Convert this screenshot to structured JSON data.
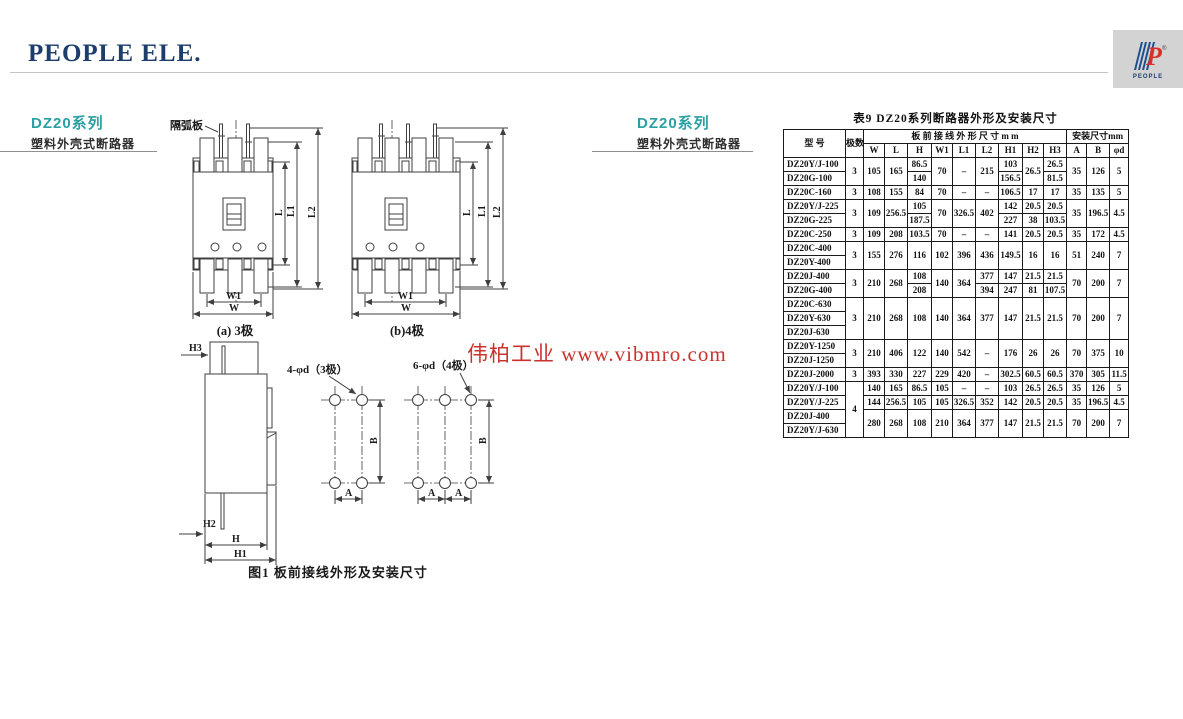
{
  "page": {
    "brand": "PEOPLE ELE.",
    "logo": {
      "p": "P",
      "word": "PEOPLE",
      "reg": "®"
    }
  },
  "sections": {
    "left_heading": {
      "series": "DZ20系列",
      "subtitle": "塑料外壳式断路器"
    },
    "mid_heading": {
      "series": "DZ20系列",
      "subtitle": "塑料外壳式断路器"
    }
  },
  "figure": {
    "arc_plate_label": "隔弧板",
    "caption_a": "(a) 3极",
    "caption_b": "(b)4极",
    "hole_label_3p": "4-φd（3极）",
    "hole_label_4p": "6-φd（4极）",
    "caption": "图1 板前接线外形及安装尺寸",
    "dims": {
      "L": "L",
      "L1": "L1",
      "L2": "L2",
      "W": "W",
      "W1": "W1",
      "H": "H",
      "H1": "H1",
      "H2": "H2",
      "H3": "H3",
      "A": "A",
      "B": "B"
    }
  },
  "watermark": "伟柏工业 www.vibmro.com",
  "table": {
    "title": "表9 DZ20系列断路器外形及安装尺寸",
    "header": {
      "model": "型  号",
      "poles": "极数",
      "group1": "板 前 接 线 外 形 尺 寸 m m",
      "group2": "安装尺寸mm",
      "cols": [
        "W",
        "L",
        "H",
        "W1",
        "L1",
        "L2",
        "H1",
        "H2",
        "H3",
        "A",
        "B",
        "φd"
      ]
    },
    "rows": [
      [
        [
          "DZ20Y/J-100"
        ],
        [
          "3",
          2
        ],
        [
          "105",
          2
        ],
        [
          "165",
          2
        ],
        [
          "86.5"
        ],
        [
          "70",
          2
        ],
        [
          "–",
          2
        ],
        [
          "215",
          2
        ],
        [
          "103"
        ],
        [
          "26.5",
          2
        ],
        [
          "26.5"
        ],
        [
          "35",
          2
        ],
        [
          "126",
          2
        ],
        [
          "5",
          2
        ]
      ],
      [
        [
          "DZ20G-100"
        ],
        [
          "140"
        ],
        [
          "156.5"
        ],
        [
          "81.5"
        ]
      ],
      [
        [
          "DZ20C-160"
        ],
        [
          "3"
        ],
        [
          "108"
        ],
        [
          "155"
        ],
        [
          "84"
        ],
        [
          "70"
        ],
        [
          "–"
        ],
        [
          "–"
        ],
        [
          "106.5"
        ],
        [
          "17"
        ],
        [
          "17"
        ],
        [
          "35"
        ],
        [
          "135"
        ],
        [
          "5"
        ]
      ],
      [
        [
          "DZ20Y/J-225"
        ],
        [
          "3",
          2
        ],
        [
          "109",
          2
        ],
        [
          "256.5",
          2
        ],
        [
          "105"
        ],
        [
          "70",
          2
        ],
        [
          "326.5",
          2
        ],
        [
          "402",
          2
        ],
        [
          "142"
        ],
        [
          "20.5"
        ],
        [
          "20.5"
        ],
        [
          "35",
          2
        ],
        [
          "196.5",
          2
        ],
        [
          "4.5",
          2
        ]
      ],
      [
        [
          "DZ20G-225"
        ],
        [
          "187.5"
        ],
        [
          "227"
        ],
        [
          "38"
        ],
        [
          "103.5"
        ]
      ],
      [
        [
          "DZ20C-250"
        ],
        [
          "3"
        ],
        [
          "109"
        ],
        [
          "208"
        ],
        [
          "103.5"
        ],
        [
          "70"
        ],
        [
          "–"
        ],
        [
          "–"
        ],
        [
          "141"
        ],
        [
          "20.5"
        ],
        [
          "20.5"
        ],
        [
          "35"
        ],
        [
          "172"
        ],
        [
          "4.5"
        ]
      ],
      [
        [
          "DZ20C-400"
        ],
        [
          "3",
          2
        ],
        [
          "155",
          2
        ],
        [
          "276",
          2
        ],
        [
          "116",
          2
        ],
        [
          "102",
          2
        ],
        [
          "396",
          2
        ],
        [
          "436",
          2
        ],
        [
          "149.5",
          2
        ],
        [
          "16",
          2
        ],
        [
          "16",
          2
        ],
        [
          "51",
          2
        ],
        [
          "240",
          2
        ],
        [
          "7",
          2
        ]
      ],
      [
        [
          "DZ20Y-400"
        ]
      ],
      [
        [
          "DZ20J-400"
        ],
        [
          "3",
          2
        ],
        [
          "210",
          2
        ],
        [
          "268",
          2
        ],
        [
          "108"
        ],
        [
          "140",
          2
        ],
        [
          "364",
          2
        ],
        [
          "377"
        ],
        [
          "147"
        ],
        [
          "21.5"
        ],
        [
          "21.5"
        ],
        [
          "70",
          2
        ],
        [
          "200",
          2
        ],
        [
          "7",
          2
        ]
      ],
      [
        [
          "DZ20G-400"
        ],
        [
          "208"
        ],
        [
          "394"
        ],
        [
          "247"
        ],
        [
          "81"
        ],
        [
          "107.5"
        ]
      ],
      [
        [
          "DZ20C-630"
        ],
        [
          "3",
          3
        ],
        [
          "210",
          3
        ],
        [
          "268",
          3
        ],
        [
          "108",
          3
        ],
        [
          "140",
          3
        ],
        [
          "364",
          3
        ],
        [
          "377",
          3
        ],
        [
          "147",
          3
        ],
        [
          "21.5",
          3
        ],
        [
          "21.5",
          3
        ],
        [
          "70",
          3
        ],
        [
          "200",
          3
        ],
        [
          "7",
          3
        ]
      ],
      [
        [
          "DZ20Y-630"
        ]
      ],
      [
        [
          "DZ20J-630"
        ]
      ],
      [
        [
          "DZ20Y-1250"
        ],
        [
          "3",
          2
        ],
        [
          "210",
          2
        ],
        [
          "406",
          2
        ],
        [
          "122",
          2
        ],
        [
          "140",
          2
        ],
        [
          "542",
          2
        ],
        [
          "–",
          2
        ],
        [
          "176",
          2
        ],
        [
          "26",
          2
        ],
        [
          "26",
          2
        ],
        [
          "70",
          2
        ],
        [
          "375",
          2
        ],
        [
          "10",
          2
        ]
      ],
      [
        [
          "DZ20J-1250"
        ]
      ],
      [
        [
          "DZ20J-2000"
        ],
        [
          "3"
        ],
        [
          "393"
        ],
        [
          "330"
        ],
        [
          "227"
        ],
        [
          "229"
        ],
        [
          "420"
        ],
        [
          "–"
        ],
        [
          "302.5"
        ],
        [
          "60.5"
        ],
        [
          "60.5"
        ],
        [
          "370"
        ],
        [
          "305"
        ],
        [
          "11.5"
        ]
      ],
      [
        [
          "DZ20Y/J-100"
        ],
        [
          "4",
          4
        ],
        [
          "140"
        ],
        [
          "165"
        ],
        [
          "86.5"
        ],
        [
          "105"
        ],
        [
          "–"
        ],
        [
          "–"
        ],
        [
          "103"
        ],
        [
          "26.5"
        ],
        [
          "26.5"
        ],
        [
          "35"
        ],
        [
          "126"
        ],
        [
          "5"
        ]
      ],
      [
        [
          "DZ20Y/J-225"
        ],
        [
          "144"
        ],
        [
          "256.5"
        ],
        [
          "105"
        ],
        [
          "105"
        ],
        [
          "326.5"
        ],
        [
          "352"
        ],
        [
          "142"
        ],
        [
          "20.5"
        ],
        [
          "20.5"
        ],
        [
          "35"
        ],
        [
          "196.5"
        ],
        [
          "4.5"
        ]
      ],
      [
        [
          "DZ20J-400"
        ],
        [
          "280",
          2
        ],
        [
          "268",
          2
        ],
        [
          "108",
          2
        ],
        [
          "210",
          2
        ],
        [
          "364",
          2
        ],
        [
          "377",
          2
        ],
        [
          "147",
          2
        ],
        [
          "21.5",
          2
        ],
        [
          "21.5",
          2
        ],
        [
          "70",
          2
        ],
        [
          "200",
          2
        ],
        [
          "7",
          2
        ]
      ],
      [
        [
          "DZ20Y/J-630"
        ]
      ]
    ]
  }
}
